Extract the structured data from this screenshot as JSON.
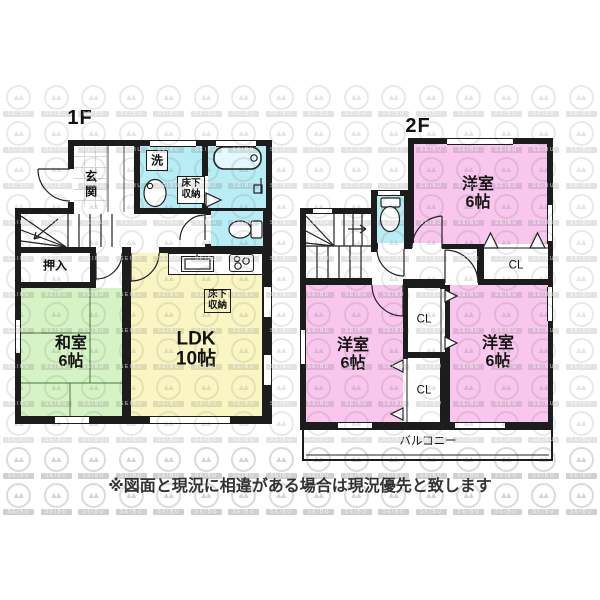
{
  "floor1": {
    "label": "1F",
    "rooms": {
      "genkan": "玄関",
      "washer": "洗",
      "underfloor_storage": {
        "line1": "床下",
        "line2": "収納"
      },
      "oshiire": "押入",
      "washitsu": {
        "name": "和室",
        "size": "6帖"
      },
      "ldk": {
        "name": "LDK",
        "size": "10帖"
      },
      "ldk_underfloor": {
        "line1": "床下",
        "line2": "収納"
      }
    }
  },
  "floor2": {
    "label": "2F",
    "rooms": {
      "bedroom_top": {
        "name": "洋室",
        "size": "6帖"
      },
      "bedroom_left": {
        "name": "洋室",
        "size": "6帖"
      },
      "bedroom_right": {
        "name": "洋室",
        "size": "6帖"
      },
      "closet_top": "CL",
      "closet_mid": "CL",
      "closet_bottom": "CL",
      "balcony": "バルコニー"
    }
  },
  "footer": {
    "disclaimer": "※図面と現況に相違がある場合は現況優先と致します"
  },
  "watermark": {
    "text": "SEIBU",
    "glyph": "▲▲",
    "cols": 16,
    "rows": 12
  },
  "colors": {
    "wall": "#1c1c1c",
    "water_rooms": "#b9edf5",
    "western_room": "#f9c7ee",
    "japanese_room": "#d6f3c6",
    "ldk": "#faf6c4"
  }
}
